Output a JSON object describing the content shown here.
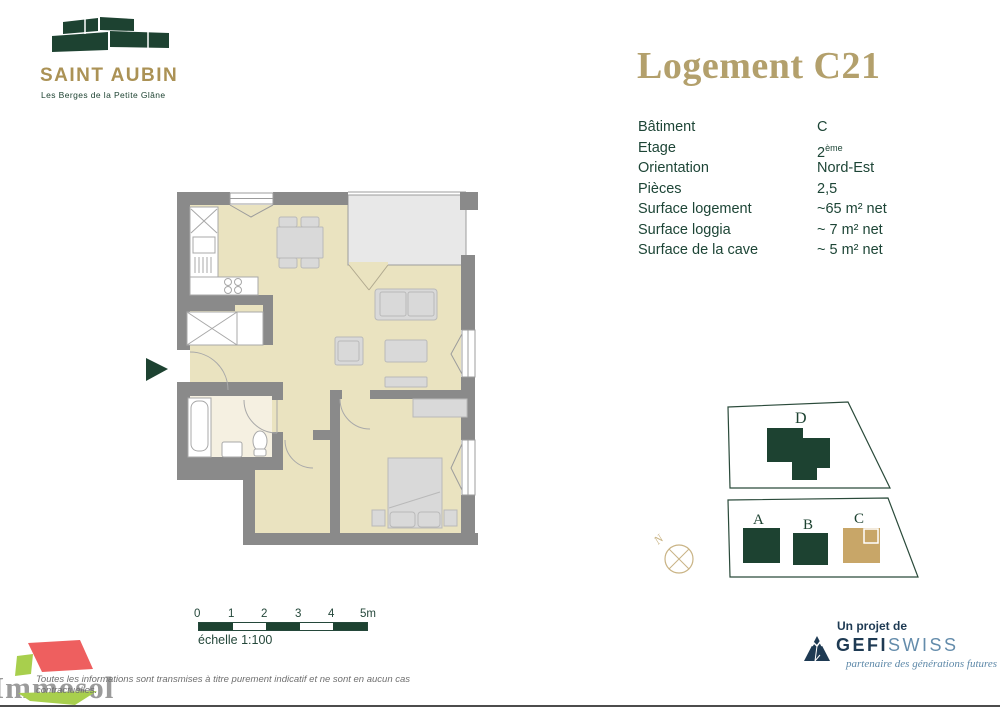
{
  "header": {
    "logo_title": "SAINT AUBIN",
    "logo_subtitle": "Les Berges de la Petite Glâne",
    "title": "Logement C21"
  },
  "details": {
    "rows": [
      {
        "label": "Bâtiment",
        "value": "C"
      },
      {
        "label": "Etage",
        "value": "2",
        "sup": "ème"
      },
      {
        "label": "Orientation",
        "value": "Nord-Est"
      },
      {
        "label": "Pièces",
        "value": "2,5"
      },
      {
        "label": "Surface logement",
        "value": "~65 m² net"
      },
      {
        "label": "Surface loggia",
        "value": "~ 7 m² net"
      },
      {
        "label": "Surface de la cave",
        "value": "~ 5 m² net"
      }
    ]
  },
  "scale_bar": {
    "ticks": [
      "0",
      "1",
      "2",
      "3",
      "4",
      "5m"
    ],
    "caption": "échelle 1:100"
  },
  "site_plan": {
    "labels": {
      "a": "A",
      "b": "B",
      "c": "C",
      "d": "D"
    },
    "highlighted_building": "C",
    "compass_n": "N"
  },
  "footer": {
    "immosol_name": "Immosol",
    "disclaimer": "Toutes les informations sont transmises à titre purement indicatif et ne sont en aucun cas contractuelles.",
    "gefiswiss": {
      "prefix": "Un projet de",
      "brand_bold": "GEFI",
      "brand_light": "SWISS",
      "tagline": "partenaire des générations futures"
    }
  },
  "colors": {
    "dark_green": "#1d4231",
    "gold": "#b3a06c",
    "building_c_tan": "#c8a668",
    "navy": "#1e3a53",
    "light_blue": "#648cab",
    "immosol_red": "#ee5f5f",
    "immosol_green": "#a8cf4d",
    "wall_gray": "#8a8a8a",
    "floor_beige": "#eae3c0",
    "loggia_gray": "#e8e8e8"
  }
}
